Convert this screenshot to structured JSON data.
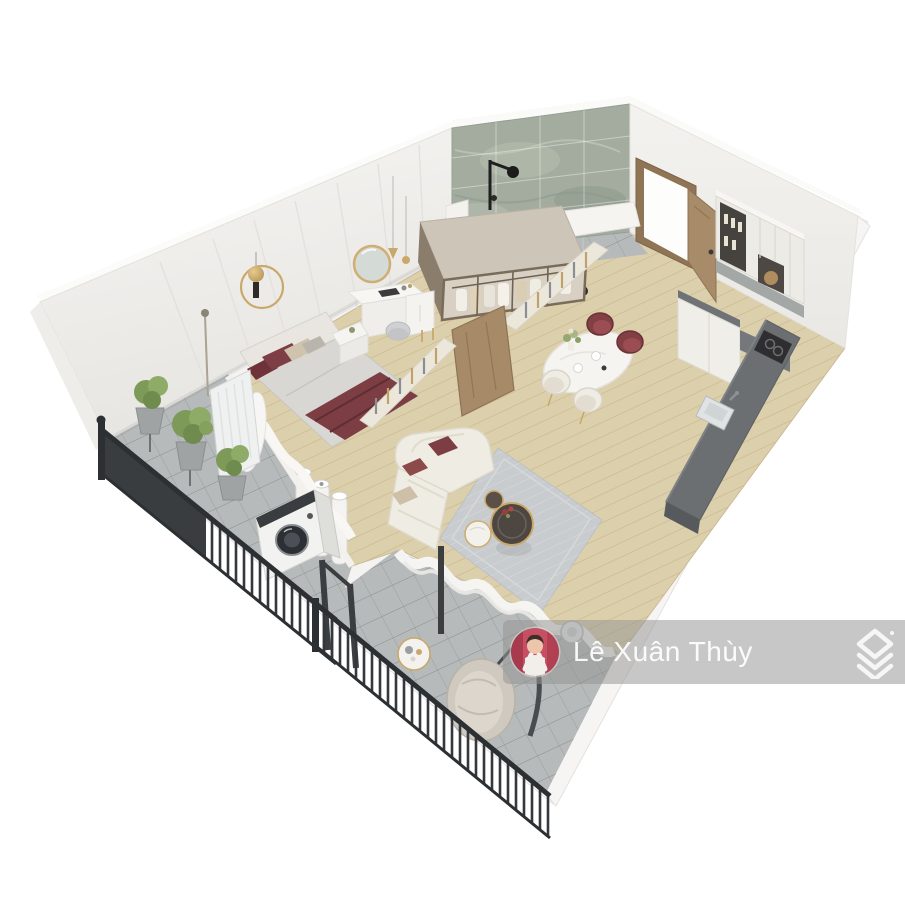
{
  "image": {
    "type": "3d-isometric-apartment-floor-plan-render",
    "background": "#ffffff"
  },
  "watermark": {
    "name": "Lê Xuân Thùy",
    "bar_color": "rgba(148,148,148,0.52)",
    "text_color": "#ffffff",
    "avatar_background": "#c24a5e",
    "avatar_description": "woman-portrait",
    "logo": "stacked-roof-chevrons"
  },
  "palette": {
    "wall": "#f1f0ed",
    "wall_shade": "#e5e4e0",
    "wood_floor": "#dccfab",
    "tile_floor": "#b6baba",
    "marble_wall": "#a3ac9f",
    "railing": "#33363a",
    "maroon_accent": "#7c3e43",
    "gold_accent": "#c9a96a",
    "counter_dark": "#6b6f71",
    "rug": "#c9ccce",
    "plant_green": "#80995c",
    "cream_sofa": "#efece3",
    "door_wood": "#a88b69"
  },
  "scene": {
    "rooms": [
      "bedroom",
      "walk-in-closet",
      "shower-room",
      "entry",
      "kitchen",
      "dining-area",
      "living-room",
      "laundry-balcony",
      "lounge-balcony"
    ],
    "objects": [
      "double-bed",
      "round-vanity-mirror",
      "vanity-desk",
      "vanity-stool",
      "bedside-table",
      "gold-ring-wall-decor",
      "pendant-lights",
      "floor-lamp",
      "wardrobe-with-clothes",
      "marble-shower-wall",
      "shower-fixture",
      "entry-door",
      "kitchen-upper-cabinets",
      "kitchen-lower-cabinets",
      "kitchen-island-counter",
      "sink",
      "cooktop",
      "dining-table",
      "dining-chairs",
      "slat-partition",
      "pivot-wood-door",
      "white-pipes",
      "curved-sofa",
      "coffee-tables",
      "area-rug",
      "sheer-curtains",
      "potted-plants",
      "washing-machine",
      "radiator-panel",
      "metal-balcony-railings",
      "hanging-chair",
      "balcony-side-table",
      "wall-fan"
    ]
  }
}
